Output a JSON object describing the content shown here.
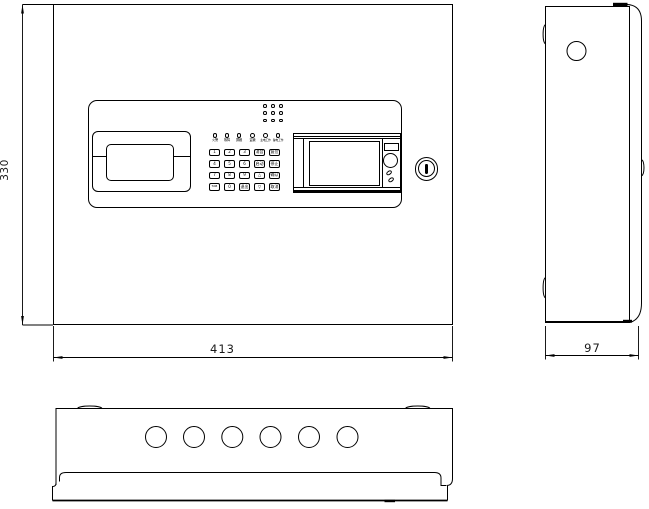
{
  "dimensions": {
    "height": "330",
    "width": "413",
    "depth": "97"
  },
  "panel": {
    "led_labels": [
      "火警",
      "故障",
      "屏蔽",
      "监管",
      "主电工作",
      "备电工作"
    ],
    "keypad_rows": [
      [
        "1",
        "2",
        "3",
        "消音",
        "复位"
      ],
      [
        "4",
        "5",
        "6",
        "启动",
        "停止"
      ],
      [
        "7",
        "8",
        "9",
        "△",
        "确认"
      ],
      [
        "TAB",
        "0",
        "退出",
        "▽",
        "取消"
      ]
    ]
  },
  "colors": {
    "line": "#000000",
    "background": "#ffffff"
  }
}
